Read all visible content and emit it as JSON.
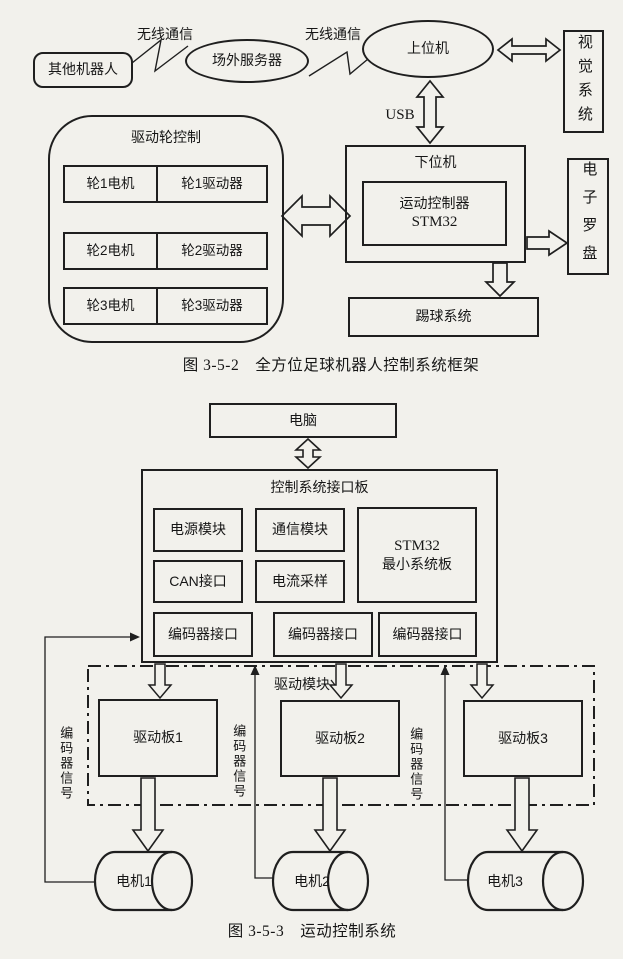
{
  "colors": {
    "background": "#f2f1ec",
    "line": "#1f1f1f"
  },
  "diagram1": {
    "caption": "图 3-5-2　全方位足球机器人控制系统框架",
    "wireless1": "无线通信",
    "wireless2": "无线通信",
    "other_robots": "其他机器人",
    "field_server": "场外服务器",
    "host_computer": "上位机",
    "usb": "USB",
    "vision_system": "视觉系统",
    "lower_computer_title": "下位机",
    "motion_controller": {
      "line1": "运动控制器",
      "line2": "STM32"
    },
    "compass": "电子罗盘",
    "kick_system": "踢球系统",
    "wheel_control_title": "驱动轮控制",
    "wheel_rows": [
      {
        "motor": "轮1电机",
        "driver": "轮1驱动器"
      },
      {
        "motor": "轮2电机",
        "driver": "轮2驱动器"
      },
      {
        "motor": "轮3电机",
        "driver": "轮3驱动器"
      }
    ]
  },
  "diagram2": {
    "caption": "图 3-5-3　运动控制系统",
    "computer": "电脑",
    "board_title": "控制系统接口板",
    "modules": {
      "power": "电源模块",
      "comm": "通信模块",
      "can": "CAN接口",
      "current": "电流采样"
    },
    "stm32": {
      "line1": "STM32",
      "line2": "最小系统板"
    },
    "encoder_ports": [
      "编码器接口",
      "编码器接口",
      "编码器接口"
    ],
    "drive_module_label": "驱动模块",
    "drive_boards": [
      "驱动板1",
      "驱动板2",
      "驱动板3"
    ],
    "encoder_signals": [
      "编码器信号",
      "编码器信号",
      "编码器信号"
    ],
    "motors": [
      "电机1",
      "电机2",
      "电机3"
    ]
  }
}
